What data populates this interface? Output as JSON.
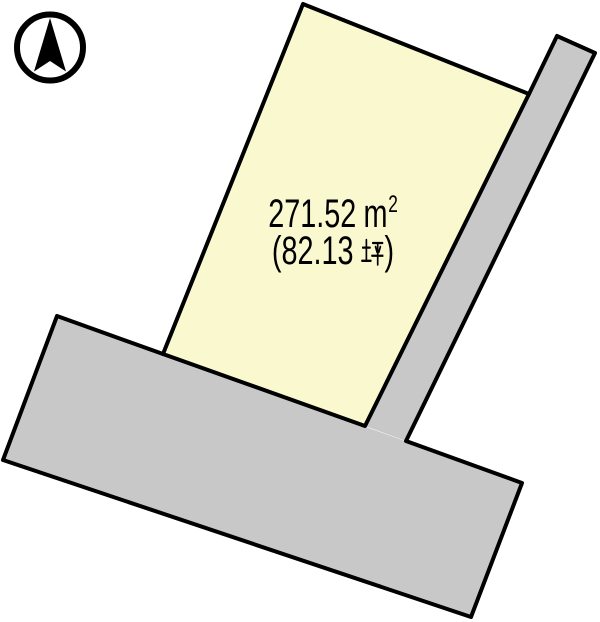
{
  "page": {
    "background_color": "#FFFFFF"
  },
  "compass": {
    "icon": "north-arrow",
    "color": "#000000"
  },
  "parcel": {
    "area_m2": "271.52 ㎡",
    "area_m2_value": "271.52",
    "area_m2_unit_base": "m",
    "area_m2_unit_exponent": "2",
    "area_tsubo": "(82.13 坪)",
    "area_tsubo_open": "(",
    "area_tsubo_value": "82.13",
    "area_tsubo_unit": "坪",
    "area_tsubo_close": ")",
    "fill": "#FAF8CE",
    "points": "303,4 529,94 365,426 163,354"
  },
  "roads": {
    "fill": "#C8C8C8",
    "right_road_points": "557,36 595,53 406,441 365,426",
    "bottom_road_points": "57,316 522,483 471,617 3,460"
  },
  "outlines": {
    "color": "#000000",
    "parcel_d": "M303,4 L529,94 L365,426 L163,354 Z",
    "roads_d": "M557,36 L595,53 L406,441 M557,36 L529,94 M57,316 L163,354 M406,441 L522,483 L471,617 L3,460 L57,316"
  }
}
